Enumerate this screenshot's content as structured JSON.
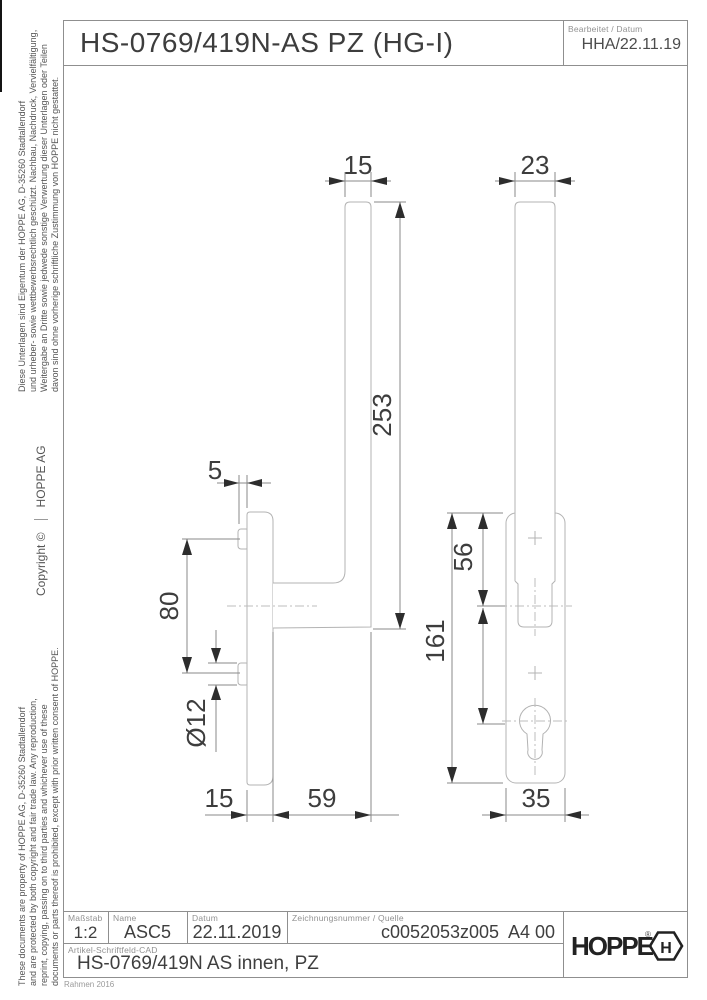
{
  "header": {
    "title": "HS-0769/419N-AS PZ (HG-I)",
    "edited_label": "Bearbeitet / Datum",
    "edited_value": "HHA/22.11.19"
  },
  "margin": {
    "de": [
      "Diese Unterlagen sind Eigentum der  HOPPE AG, D-35260 Stadtallendorf",
      "und urheber- sowie wettbewerbsrechtlich geschützt. Nachbau, Nachdruck, Vervielfältigung,",
      "Weitergabe an Dritte sowie jedwede sonstige Verwertung dieser Unterlagen oder Teilen",
      "davon sind ohne vorherige schriftliche Zustimmung von HOPPE nicht gestattet."
    ],
    "copyright": "Copyright ©",
    "company": "HOPPE  AG",
    "en": [
      "These documents are property of HOPPE AG, D-35260 Stadtallendorf",
      "and are protected by both copyright and fair trade law. Any reproduction,",
      "reprint, copying, passing on to third parties and whichever use of these",
      "documents or parts thereof is prohibited, except with prior written consent of HOPPE."
    ]
  },
  "dims": {
    "grip_width_side": "15",
    "grip_width_front": "23",
    "total_length": "253",
    "boss_projection": "5",
    "screw_distance": "80",
    "boss_diameter": "Ø12",
    "plate_depth": "15",
    "handle_projection": "59",
    "axis_offset": "56",
    "plate_length": "161",
    "plate_width": "35"
  },
  "titleblock": {
    "masstab_label": "Maßstab",
    "masstab": "1:2",
    "name_label": "Name",
    "name": "ASC5",
    "datum_label": "Datum",
    "datum": "22.11.2019",
    "zeichnung_label": "Zeichnungsnummer / Quelle",
    "zeichnung": "c0052053z005",
    "format": "A4 00",
    "artikel_label": "Artikel-Schriftfeld-CAD",
    "artikel": "HS-0769/419N AS  innen, PZ",
    "frame_note": "Rahmen 2016"
  },
  "logo": {
    "brand": "HOPPE",
    "reg": "®",
    "hex_letter": "H"
  }
}
